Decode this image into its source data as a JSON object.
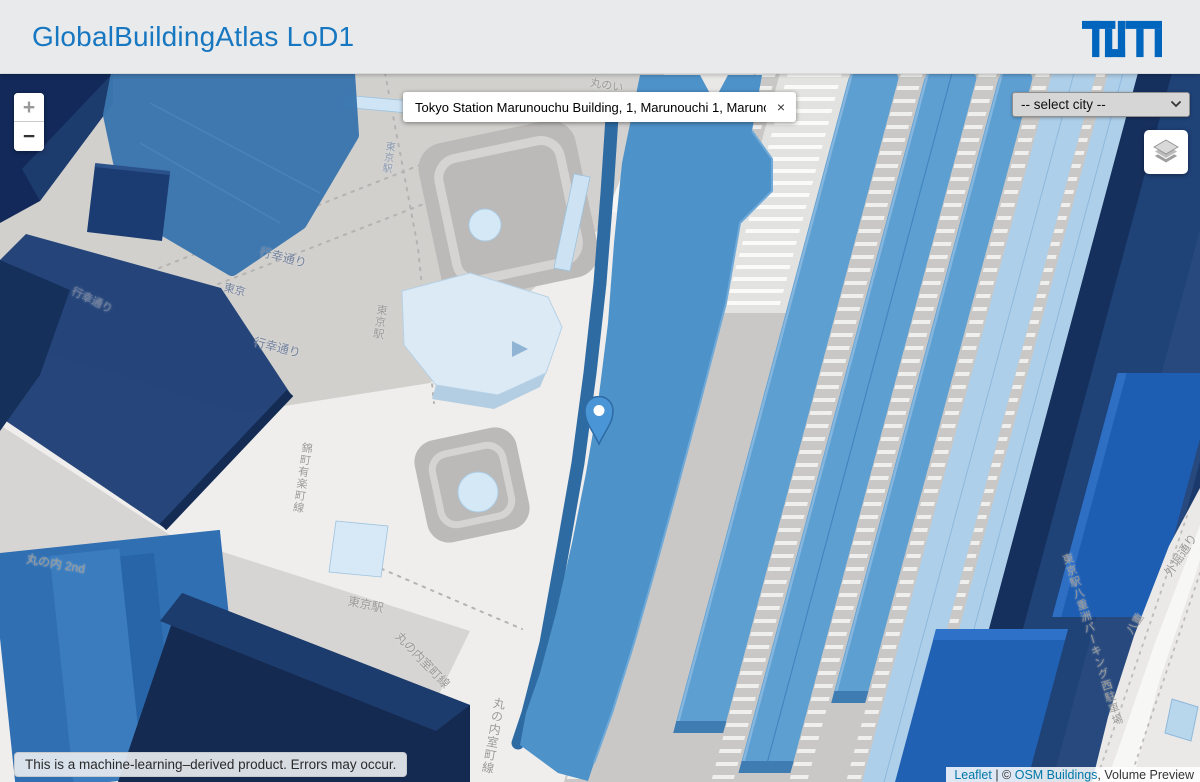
{
  "header": {
    "title": "GlobalBuildingAtlas LoD1",
    "logo_alt": "TUM"
  },
  "controls": {
    "zoom_in": "+",
    "zoom_out": "−",
    "city_select_value": "-- select city --"
  },
  "search": {
    "value": "Tokyo Station Marunouchu Building, 1, Marunouchi 1, Marunouchi,",
    "clear_label": "×"
  },
  "disclaimer": "This is a machine-learning–derived product. Errors may occur.",
  "attribution": {
    "leaflet": "Leaflet",
    "divider": " | ",
    "copyright": "© ",
    "osm_buildings": "OSM Buildings",
    "suffix": ", Volume Preview"
  },
  "map_labels": [
    {
      "text": "行幸通り"
    },
    {
      "text": "行幸通り"
    },
    {
      "text": "行幸通り"
    },
    {
      "text": "東京"
    },
    {
      "text": "東京駅"
    },
    {
      "text": "東京駅"
    },
    {
      "text": "丸の内 2nd"
    },
    {
      "text": "丸の内室町線"
    },
    {
      "text": "丸の内室町線"
    },
    {
      "text": "錦町有楽町線"
    },
    {
      "text": "丸のい"
    },
    {
      "text": "東京駅"
    },
    {
      "text": "東京駅八重洲パーキング西駐車場"
    },
    {
      "text": "外堀通り"
    },
    {
      "text": "八重"
    }
  ],
  "colors": {
    "tum_blue": "#0065bd",
    "title_blue": "#1777c0",
    "station_blue": "#4d92c9",
    "building_navy": "#1f4077",
    "building_royal": "#1d5db2",
    "platform_mid": "#5e9fd2",
    "platform_light": "#aecfe9",
    "link_blue": "#0078a8"
  }
}
